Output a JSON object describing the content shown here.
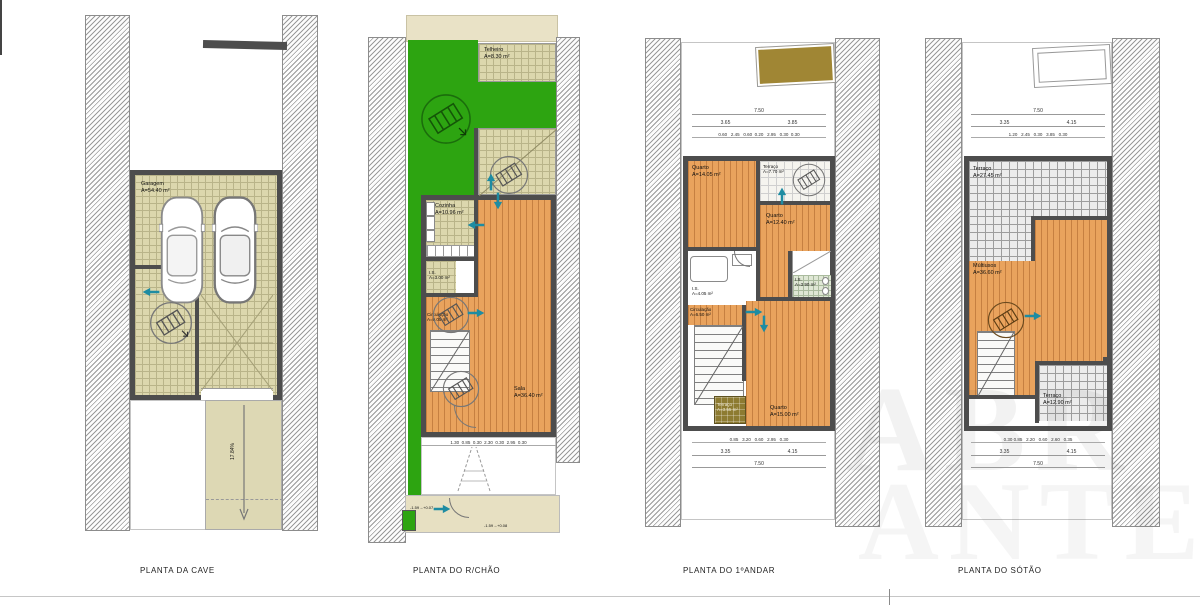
{
  "sheet": {
    "captions": {
      "cave": "PLANTA  DA CAVE",
      "rchao": "PLANTA DO R/CHÃO",
      "andar": "PLANTA DO 1ºANDAR",
      "sotao": "PLANTA DO SÓTÃO"
    },
    "watermark": {
      "line1": "ABR",
      "line2": "ANTES"
    }
  },
  "colors": {
    "wood_floor": "#e9a35d",
    "garden_green": "#2da411",
    "tile_beige": "#dcd7ad",
    "wall_gray": "#4d4d4d",
    "terrain_beige": "#e9e2c6",
    "canopy_olive": "#a08634",
    "arrow_teal": "#1e8ca2"
  },
  "icons": {
    "tree_symbol": "planter-circle",
    "direction_arrow": "teal-flow-arrow",
    "car": "car-top-view"
  },
  "cave": {
    "garage": {
      "name": "Garagem",
      "area": "A=54.40 m²"
    },
    "ramp_slope": "17.84%"
  },
  "rchao": {
    "telheiro": {
      "name": "Telheiro",
      "area": "A=8.30 m²"
    },
    "cozinha": {
      "name": "Cozinha",
      "area": "A=10.96 m²"
    },
    "is": {
      "name": "I.S.",
      "area": "A=3.00 m²"
    },
    "circulacao": {
      "name": "Circulação",
      "area": "A=9.05 m²"
    },
    "sala": {
      "name": "Sala",
      "area": "A=36.40 m²"
    },
    "level_front": "-1.59→+0.07",
    "level_path": "-1.59→+0.08",
    "dims_bottom": "1.30  0.85  0.30  2.30  0.30  2.95  0.30"
  },
  "andar": {
    "quarto1": {
      "name": "Quarto",
      "area": "A=14.05 m²"
    },
    "terraco1": {
      "name": "Terraço",
      "area": "A=7.70 m²"
    },
    "quarto2": {
      "name": "Quarto",
      "area": "A=12.40 m²"
    },
    "is1": {
      "name": "I.S.",
      "area": "A=4.05 m²"
    },
    "circulacao": {
      "name": "Circulação",
      "area": "A=6.50 m²"
    },
    "is2": {
      "name": "I.S.",
      "area": "A=3.90 m²"
    },
    "quarto3": {
      "name": "Quarto",
      "area": "A=15.00 m²"
    },
    "terraco2": {
      "name": "Terraço",
      "area": "A=3.55 m²"
    },
    "dims": {
      "top_total": "7.50",
      "top_a": "3.65",
      "top_b": "3.85",
      "top_row": "0.60   2.45   0.60  0.20   2.95   0.30  0.30",
      "bottom_row": "0.85   3.20   0.60   2.95   0.30",
      "bottom_a": "3.35",
      "bottom_b": "4.15",
      "bottom_total": "7.50"
    }
  },
  "sotao": {
    "terraco1": {
      "name": "Terraço",
      "area": "A=27.45 m²"
    },
    "multiusos": {
      "name": "Múltiusos",
      "area": "A=36.60 m²"
    },
    "terraco2": {
      "name": "Terraço",
      "area": "A=12.90 m²"
    },
    "dims": {
      "top_total": "7.50",
      "top_a": "3.35",
      "top_b": "4.15",
      "top_row": "1.20   2.45   0.30   3.85   0.30",
      "bottom_row": "0.30 0.85   2.20   0.60   2.60   0.35",
      "bottom_a": "3.35",
      "bottom_b": "4.15",
      "bottom_total": "7.50"
    }
  }
}
